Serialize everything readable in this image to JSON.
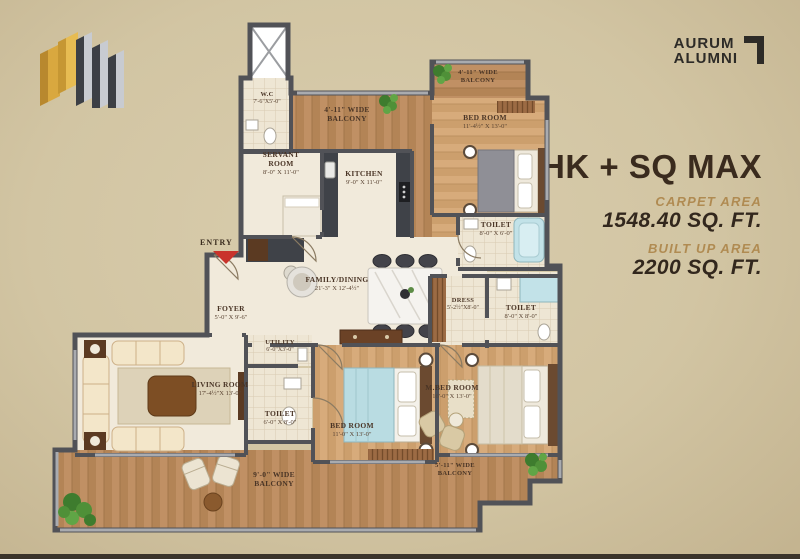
{
  "branding": {
    "name_line1": "AURUM",
    "name_line2": "ALUMNI"
  },
  "unit": {
    "title": "3BHK + SQ MAX",
    "carpet_label": "CARPET AREA",
    "carpet_value": "1548.40 SQ. FT.",
    "built_label": "BUILT UP AREA",
    "built_value": "2200 SQ. FT."
  },
  "plan": {
    "entry": "ENTRY",
    "rooms": {
      "wc": {
        "line1": "W.C",
        "dims": "7'-6\"X5'-0\""
      },
      "top_balcony": {
        "line1": "4'-11\" WIDE",
        "line2": "BALCONY"
      },
      "right_balcony": {
        "line1": "4'-11\" WIDE",
        "line2": "BALCONY"
      },
      "bedroom_top": {
        "line1": "BED ROOM",
        "dims": "11'-4½\" X 13'-0\""
      },
      "servant_room": {
        "line1": "SERVANT",
        "line2": "ROOM",
        "dims": "8'-0\" X 11'-0\""
      },
      "kitchen": {
        "line1": "KITCHEN",
        "dims": "9'-0\" X 11'-0\""
      },
      "toilet_top": {
        "line1": "TOILET",
        "dims": "8'-0\" X 6'-0\""
      },
      "family_dining": {
        "line1": "FAMILY/DINING",
        "dims": "21'-3\" X 12'-4½\""
      },
      "foyer": {
        "line1": "FOYER",
        "dims": "5'-0\" X 9'-6\""
      },
      "dress": {
        "line1": "DRESS",
        "dims": "5'-2½\"X8'-0\""
      },
      "toilet_mid": {
        "line1": "TOILET",
        "dims": "8'-0\" X 8'-0\""
      },
      "living_room": {
        "line1": "LIVING ROOM",
        "dims": "17'-4½\"X 13'-0\""
      },
      "utility": {
        "line1": "UTILITY",
        "dims": "6'-0\"X3'-0\""
      },
      "toilet_bottom": {
        "line1": "TOILET",
        "dims": "6'-0\" X 8'-0\""
      },
      "bedroom_bottom": {
        "line1": "BED ROOM",
        "dims": "11'-0\" X 13'-0\""
      },
      "master_bedroom": {
        "line1": "M.BED ROOM",
        "dims": "16'-0\" X 13'-0\""
      },
      "bottom_balcony": {
        "line1": "9'-0\" WIDE",
        "line2": "BALCONY"
      },
      "right_balcony_bottom": {
        "line1": "5'-11\" WIDE",
        "line2": "BALCONY"
      }
    },
    "colors": {
      "wall": "#515257",
      "wood": "#c09064",
      "wood_light": "#d7ab7b",
      "cream": "#f1eadb",
      "water_blue": "#c2e2e8",
      "entry_red": "#c9332b"
    }
  }
}
